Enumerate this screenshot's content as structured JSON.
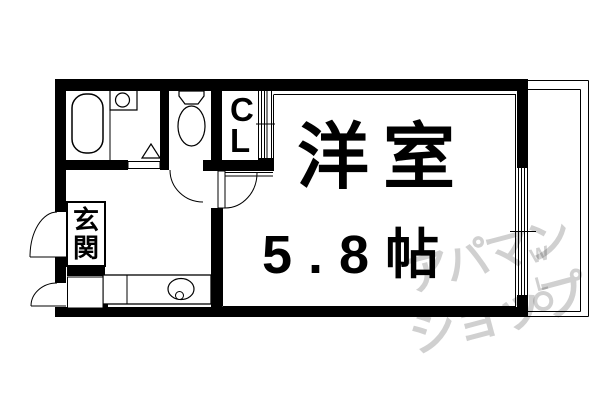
{
  "floorplan": {
    "rooms": {
      "main_room": {
        "name": "洋室",
        "size": "5.8帖"
      },
      "entrance": {
        "name": "玄関",
        "chars": [
          "玄",
          "関"
        ]
      },
      "closet": {
        "abbr": "CL",
        "chars": [
          "C",
          "L"
        ]
      }
    },
    "watermark": {
      "line1": "アパマン",
      "line2": "ショップ",
      "mark_w": "W",
      "mark_l": "L",
      "color": "#d0d0d0"
    },
    "colors": {
      "wall": "#000000",
      "background": "#ffffff",
      "line": "#000000"
    }
  }
}
